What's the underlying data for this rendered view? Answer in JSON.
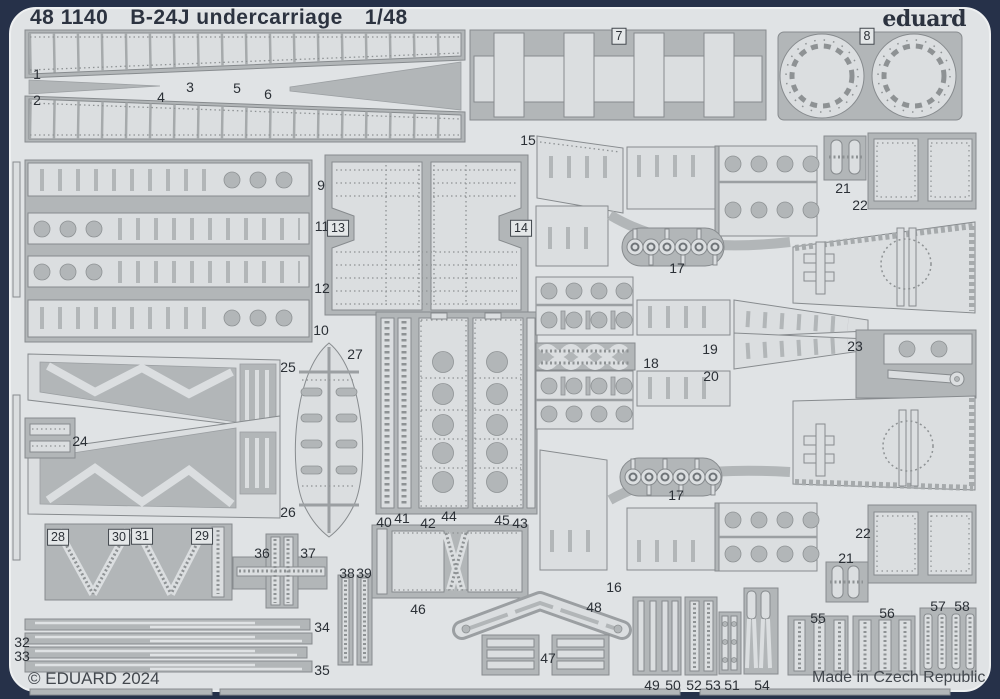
{
  "header": {
    "catalog_number": "48 1140",
    "product_name": "B-24J undercarriage",
    "scale": "1/48",
    "brand_logo": "eduard"
  },
  "footer": {
    "copyright": "© EDUARD 2024",
    "made_in": "Made in Czech Republic"
  },
  "colors": {
    "frame": "#263149",
    "sheet": "#e0e3e5",
    "carrier": "#b2b6b8",
    "part": "#dbdee0",
    "text": "#2c3340"
  },
  "sheet": {
    "kind": "photo-etched parts fret",
    "part_count_max": "58"
  },
  "part_labels": [
    {
      "n": "1",
      "x": 37,
      "y": 74
    },
    {
      "n": "2",
      "x": 37,
      "y": 100
    },
    {
      "n": "3",
      "x": 190,
      "y": 87
    },
    {
      "n": "4",
      "x": 161,
      "y": 97
    },
    {
      "n": "5",
      "x": 237,
      "y": 88
    },
    {
      "n": "6",
      "x": 268,
      "y": 94
    },
    {
      "n": "7",
      "x": 619,
      "y": 36,
      "boxed": true
    },
    {
      "n": "8",
      "x": 867,
      "y": 36,
      "boxed": true
    },
    {
      "n": "9",
      "x": 321,
      "y": 185
    },
    {
      "n": "11",
      "x": 322,
      "y": 226
    },
    {
      "n": "13",
      "x": 338,
      "y": 228,
      "boxed": true
    },
    {
      "n": "14",
      "x": 521,
      "y": 228,
      "boxed": true
    },
    {
      "n": "12",
      "x": 322,
      "y": 288
    },
    {
      "n": "10",
      "x": 321,
      "y": 330
    },
    {
      "n": "15",
      "x": 528,
      "y": 140
    },
    {
      "n": "17",
      "x": 677,
      "y": 268
    },
    {
      "n": "18",
      "x": 651,
      "y": 363
    },
    {
      "n": "19",
      "x": 710,
      "y": 349
    },
    {
      "n": "20",
      "x": 711,
      "y": 376
    },
    {
      "n": "21",
      "x": 843,
      "y": 188
    },
    {
      "n": "22",
      "x": 860,
      "y": 205
    },
    {
      "n": "23",
      "x": 855,
      "y": 346
    },
    {
      "n": "24",
      "x": 80,
      "y": 441
    },
    {
      "n": "25",
      "x": 288,
      "y": 367
    },
    {
      "n": "27",
      "x": 355,
      "y": 354
    },
    {
      "n": "26",
      "x": 288,
      "y": 512
    },
    {
      "n": "28",
      "x": 58,
      "y": 537,
      "boxed": true
    },
    {
      "n": "30",
      "x": 119,
      "y": 537,
      "boxed": true
    },
    {
      "n": "31",
      "x": 142,
      "y": 536,
      "boxed": true
    },
    {
      "n": "29",
      "x": 202,
      "y": 536,
      "boxed": true
    },
    {
      "n": "36",
      "x": 262,
      "y": 553
    },
    {
      "n": "37",
      "x": 308,
      "y": 553
    },
    {
      "n": "38",
      "x": 347,
      "y": 573
    },
    {
      "n": "39",
      "x": 364,
      "y": 573
    },
    {
      "n": "40",
      "x": 384,
      "y": 522
    },
    {
      "n": "41",
      "x": 402,
      "y": 518
    },
    {
      "n": "42",
      "x": 428,
      "y": 523
    },
    {
      "n": "44",
      "x": 449,
      "y": 516
    },
    {
      "n": "45",
      "x": 502,
      "y": 520
    },
    {
      "n": "43",
      "x": 520,
      "y": 523
    },
    {
      "n": "17",
      "x": 676,
      "y": 495
    },
    {
      "n": "16",
      "x": 614,
      "y": 587
    },
    {
      "n": "46",
      "x": 418,
      "y": 609
    },
    {
      "n": "48",
      "x": 594,
      "y": 607
    },
    {
      "n": "47",
      "x": 548,
      "y": 658
    },
    {
      "n": "32",
      "x": 22,
      "y": 642
    },
    {
      "n": "33",
      "x": 22,
      "y": 656
    },
    {
      "n": "34",
      "x": 322,
      "y": 627
    },
    {
      "n": "35",
      "x": 322,
      "y": 670
    },
    {
      "n": "49",
      "x": 652,
      "y": 685
    },
    {
      "n": "50",
      "x": 673,
      "y": 685
    },
    {
      "n": "52",
      "x": 694,
      "y": 685
    },
    {
      "n": "53",
      "x": 713,
      "y": 685
    },
    {
      "n": "51",
      "x": 732,
      "y": 685
    },
    {
      "n": "54",
      "x": 762,
      "y": 685
    },
    {
      "n": "55",
      "x": 818,
      "y": 618
    },
    {
      "n": "56",
      "x": 887,
      "y": 613
    },
    {
      "n": "57",
      "x": 938,
      "y": 606
    },
    {
      "n": "58",
      "x": 962,
      "y": 606
    },
    {
      "n": "21",
      "x": 846,
      "y": 558
    },
    {
      "n": "22",
      "x": 863,
      "y": 533
    }
  ]
}
